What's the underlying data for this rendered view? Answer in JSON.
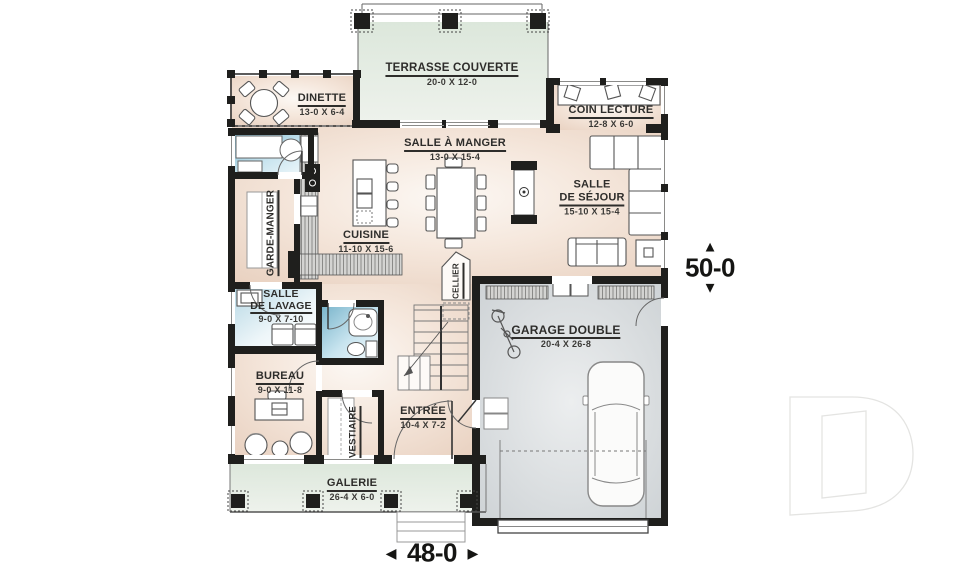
{
  "rooms": {
    "terrasse": {
      "name": "TERRASSE COUVERTE",
      "dims": "20-0 X 12-0"
    },
    "dinette": {
      "name": "DINETTE",
      "dims": "13-0 X 6-4"
    },
    "coin_lecture": {
      "name": "COIN LECTURE",
      "dims": "12-8 X 6-0"
    },
    "salle_a_manger": {
      "name": "SALLE À MANGER",
      "dims": "13-0 X 15-4"
    },
    "salle_de_sejour": {
      "line1": "SALLE",
      "line2": "DE SÉJOUR",
      "dims": "15-10 X 15-4"
    },
    "cuisine": {
      "name": "CUISINE",
      "dims": "11-10 X 15-6"
    },
    "garde_manger": {
      "name": "GARDE-MANGER"
    },
    "salle_de_lavage": {
      "line1": "SALLE",
      "line2": "DE LAVAGE",
      "dims": "9-0 X 7-10"
    },
    "cellier": {
      "name": "CELLIER"
    },
    "garage": {
      "name": "GARAGE DOUBLE",
      "dims": "20-4 X 26-8"
    },
    "bureau": {
      "name": "BUREAU",
      "dims": "9-0 X 11-8"
    },
    "entree": {
      "name": "ENTRÉE",
      "dims": "10-4 X 7-2"
    },
    "vestiaire": {
      "name": "VESTIAIRE"
    },
    "galerie": {
      "name": "GALERIE",
      "dims": "26-4 X 6-0"
    }
  },
  "overall_dimensions": {
    "width": {
      "value": "48-0",
      "arrow_left": "◄",
      "arrow_right": "►"
    },
    "depth": {
      "value": "50-0",
      "arrow_up": "▲",
      "arrow_down": "▼"
    }
  },
  "watermark": {
    "letter": "D"
  },
  "colors": {
    "wall": "#1f1f1d",
    "floor": "#f0ddcf",
    "terrace": "#e2ebe0",
    "garage": "#d7dbdd",
    "water": "#8fc1d6",
    "text": "#2e2d2b"
  }
}
